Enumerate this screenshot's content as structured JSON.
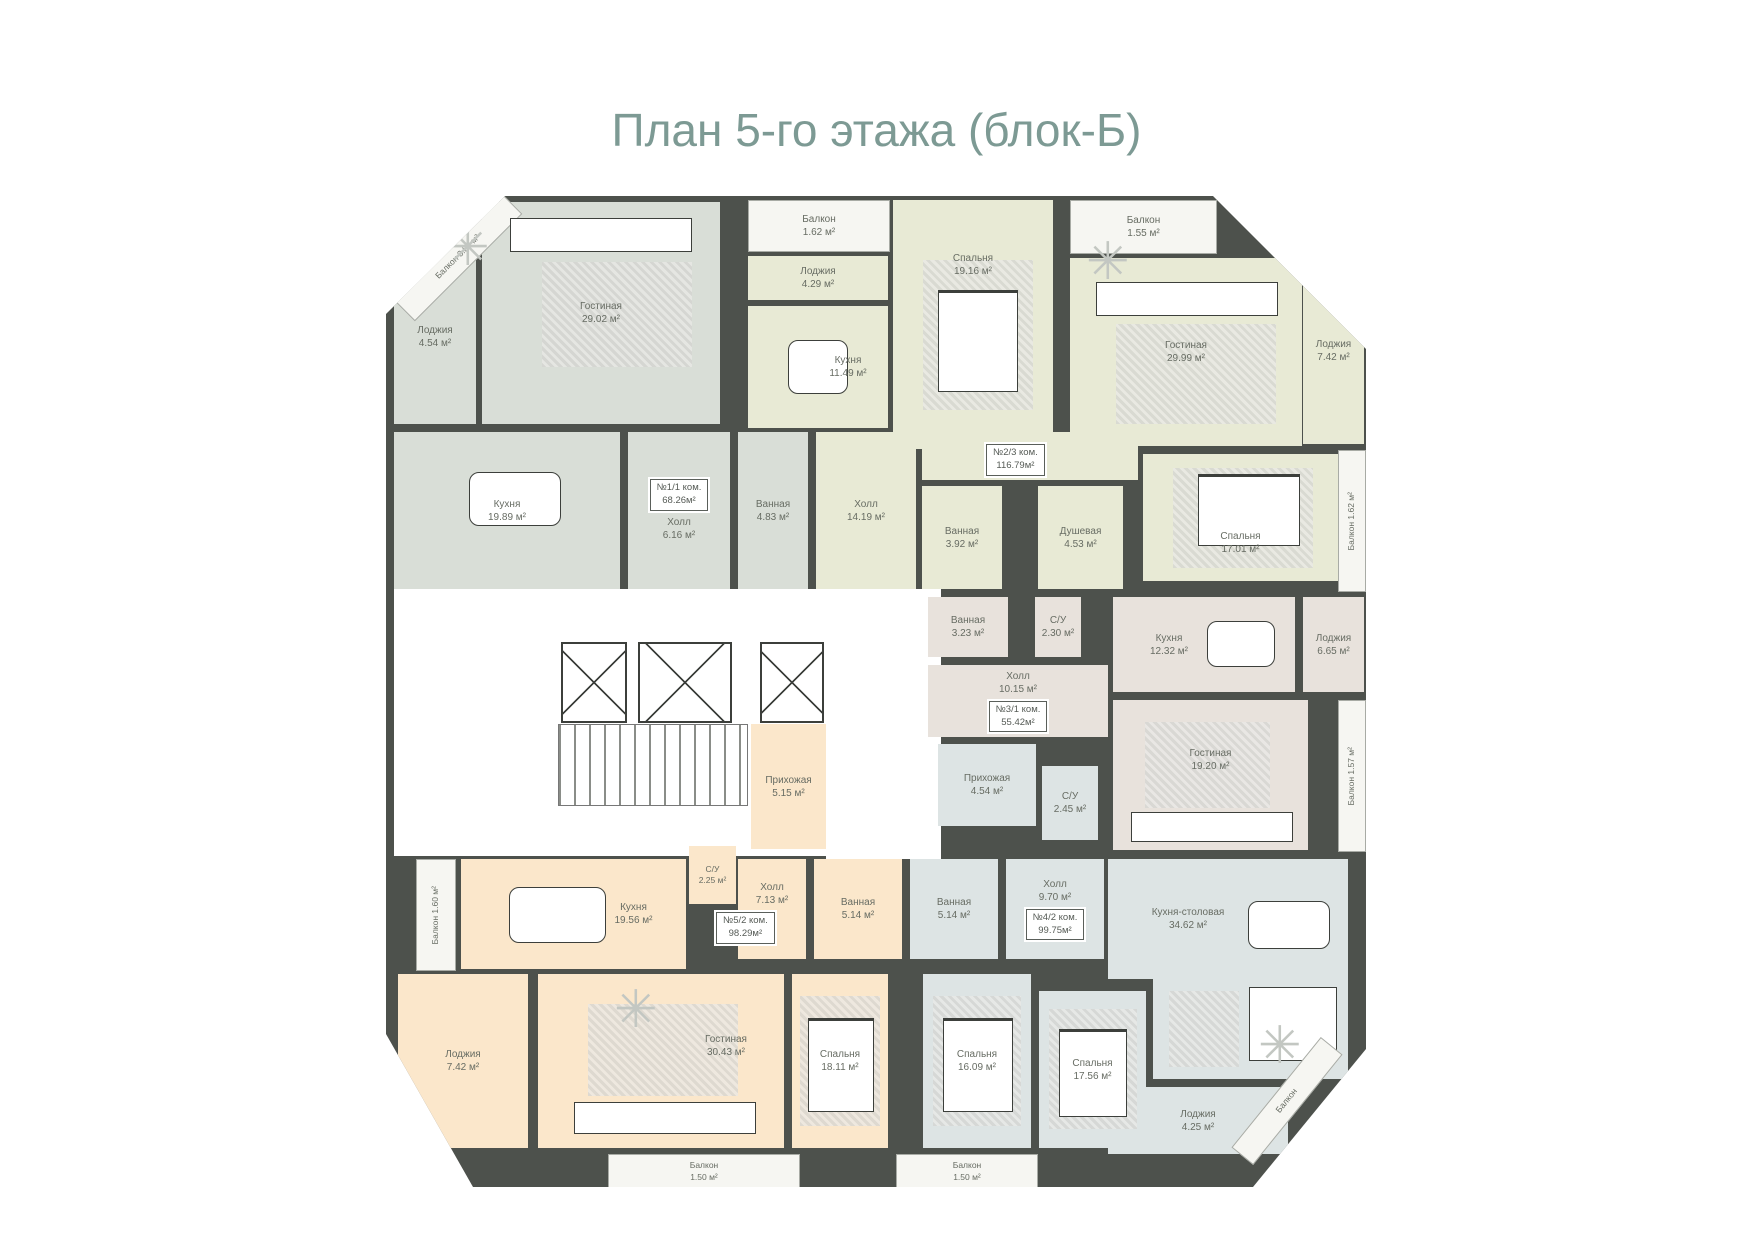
{
  "title": "План 5-го этажа (блок-Б)",
  "accent_color": "#7d9a94",
  "wall_color": "#4d514c",
  "apartments": {
    "apt1": {
      "num": "№1/1 ком.",
      "area": "68.26м²",
      "color": "#d9ded7",
      "rooms": {
        "balcony_diag": {
          "n": "Балкон",
          "a": "3.82 м²"
        },
        "loggia": {
          "n": "Лоджия",
          "a": "4.54 м²"
        },
        "living": {
          "n": "Гостиная",
          "a": "29.02 м²"
        },
        "kitchen": {
          "n": "Кухня",
          "a": "19.89 м²"
        },
        "hall": {
          "n": "Холл",
          "a": "6.16 м²"
        },
        "bath": {
          "n": "Ванная",
          "a": "4.83 м²"
        }
      }
    },
    "apt2": {
      "num": "№2/3 ком.",
      "area": "116.79м²",
      "color": "#e8ead5",
      "rooms": {
        "balcony_top": {
          "n": "Балкон",
          "a": "1.62 м²"
        },
        "loggia_top": {
          "n": "Лоджия",
          "a": "4.29 м²"
        },
        "kitchen": {
          "n": "Кухня",
          "a": "11.49 м²"
        },
        "bedroom1": {
          "n": "Спальня",
          "a": "19.16 м²"
        },
        "balcony_top2": {
          "n": "Балкон",
          "a": "1.55 м²"
        },
        "living": {
          "n": "Гостиная",
          "a": "29.99 м²"
        },
        "loggia_right": {
          "n": "Лоджия",
          "a": "7.42 м²"
        },
        "bedroom2": {
          "n": "Спальня",
          "a": "17.01 м²"
        },
        "balcony_right": {
          "n": "Балкон",
          "a": "1.62 м²"
        },
        "hall": {
          "n": "Холл",
          "a": "14.19 м²"
        },
        "bath": {
          "n": "Ванная",
          "a": "3.92 м²"
        },
        "shower": {
          "n": "Душевая",
          "a": "4.53 м²"
        }
      }
    },
    "apt3": {
      "num": "№3/1 ком.",
      "area": "55.42м²",
      "color": "#e8e2dc",
      "rooms": {
        "bath": {
          "n": "Ванная",
          "a": "3.23 м²"
        },
        "wc": {
          "n": "С/У",
          "a": "2.30 м²"
        },
        "hall": {
          "n": "Холл",
          "a": "10.15 м²"
        },
        "kitchen": {
          "n": "Кухня",
          "a": "12.32 м²"
        },
        "loggia": {
          "n": "Лоджия",
          "a": "6.65 м²"
        },
        "living": {
          "n": "Гостиная",
          "a": "19.20 м²"
        },
        "balcony_right": {
          "n": "Балкон",
          "a": "1.57 м²"
        }
      }
    },
    "apt4": {
      "num": "№4/2 ком.",
      "area": "99.75м²",
      "color": "#dde4e4",
      "rooms": {
        "entry": {
          "n": "Прихожая",
          "a": "4.54 м²"
        },
        "wc": {
          "n": "С/У",
          "a": "2.45 м²"
        },
        "bath": {
          "n": "Ванная",
          "a": "5.14 м²"
        },
        "hall": {
          "n": "Холл",
          "a": "9.70 м²"
        },
        "kitchen_dining": {
          "n": "Кухня-столовая",
          "a": "34.62 м²"
        },
        "bedroom1": {
          "n": "Спальня",
          "a": "16.09 м²"
        },
        "bedroom2": {
          "n": "Спальня",
          "a": "17.56 м²"
        },
        "loggia": {
          "n": "Лоджия",
          "a": "4.25 м²"
        },
        "balcony_bottom": {
          "n": "Балкон",
          "a": "1.50 м²"
        },
        "balcony_diag": {
          "n": "Балкон",
          "a": ""
        }
      }
    },
    "apt5": {
      "num": "№5/2 ком.",
      "area": "98.29м²",
      "color": "#fbe7cb",
      "rooms": {
        "balcony_left": {
          "n": "Балкон",
          "a": "1.60 м²"
        },
        "kitchen": {
          "n": "Кухня",
          "a": "19.56 м²"
        },
        "wc": {
          "n": "С/У",
          "a": "2.25 м²"
        },
        "hall": {
          "n": "Холл",
          "a": "7.13 м²"
        },
        "entry": {
          "n": "Прихожая",
          "a": "5.15 м²"
        },
        "loggia": {
          "n": "Лоджия",
          "a": "7.42 м²"
        },
        "living": {
          "n": "Гостиная",
          "a": "30.43 м²"
        },
        "bedroom": {
          "n": "Спальня",
          "a": "18.11 м²"
        },
        "bath": {
          "n": "Ванная",
          "a": "5.14 м²"
        },
        "balcony_bottom": {
          "n": "Балкон",
          "a": "1.50 м²"
        }
      }
    }
  },
  "common": {
    "elevators": 3,
    "stairs": 1
  }
}
